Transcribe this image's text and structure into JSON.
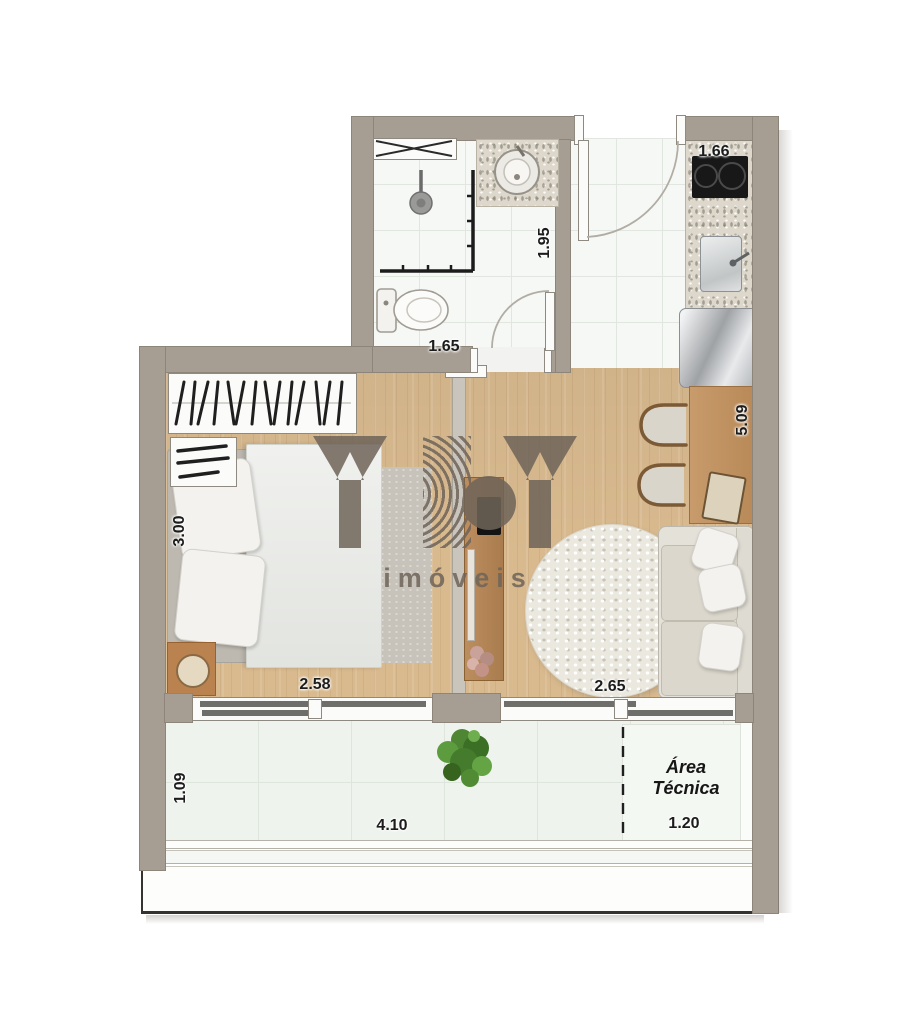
{
  "plan": {
    "dimensions": {
      "kitchen_width": "1.66",
      "bathroom_depth": "1.95",
      "bathroom_width": "1.65",
      "bedroom_depth": "3.00",
      "bedroom_width": "2.58",
      "living_depth": "5.09",
      "living_width": "2.65",
      "balcony_depth": "1.09",
      "balcony_width": "4.10",
      "technical_area_width": "1.20"
    },
    "labels": {
      "technical_area_line1": "Área",
      "technical_area_line2": "Técnica"
    },
    "watermark": {
      "subtitle": "imóveis"
    },
    "colors": {
      "wall": "#a79e93",
      "wood_floor": "#d9ba8f",
      "tile_floor": "#f6f8f5",
      "balcony_tile": "#eef3ee",
      "watermark": "#6f6459"
    }
  }
}
